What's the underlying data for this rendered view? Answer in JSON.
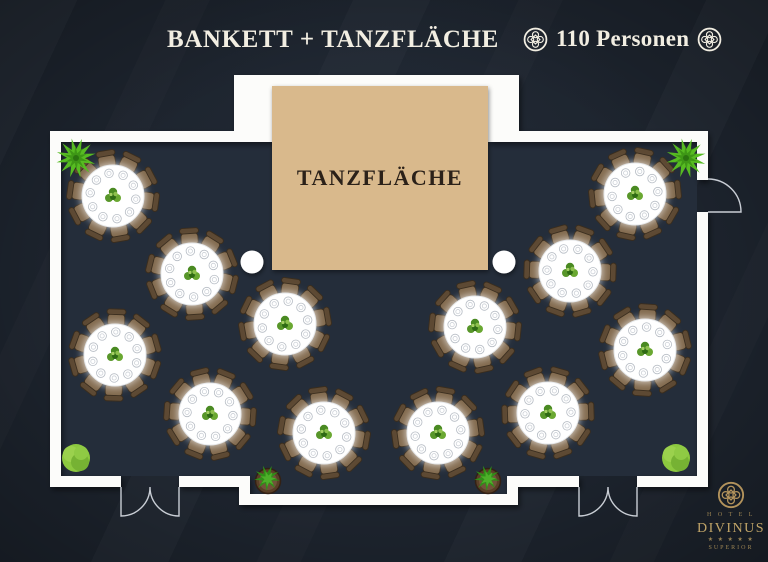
{
  "header": {
    "title": "BANKETT + TANZFLÄCHE",
    "capacity": "110 Personen",
    "ornament_icon": "celtic-knot-icon"
  },
  "floor_plan": {
    "dance_floor_label": "TANZFLÄCHE",
    "seats_per_table": 10,
    "table_count": 12,
    "colors": {
      "background": "#1d242e",
      "room_fill": "#242d3a",
      "wall": "#fcfcfa",
      "door_line": "#c9ced5",
      "dance_floor": "#d9b98c",
      "dance_floor_text": "#2b2119",
      "table_cloth": "#ffffff",
      "plate_rim": "#b6bcc4",
      "chair_seat": "#826a4e",
      "chair_back": "#5d4933",
      "chair_edge": "#3a2d1d",
      "column": "#ffffff",
      "plant_bright": "#57bb22",
      "plant_soft": "#8cc83f",
      "pot": "#5a3f27",
      "gold": "#b3935c"
    },
    "room_path": "M61,142 H697 V476 H507 V494 H250 V476 H61 Z",
    "walls": [
      [
        50,
        131,
        11,
        356
      ],
      [
        50,
        131,
        195,
        11
      ],
      [
        234,
        75,
        38,
        67
      ],
      [
        234,
        75,
        285,
        11
      ],
      [
        488,
        75,
        31,
        67
      ],
      [
        508,
        131,
        200,
        11
      ],
      [
        697,
        131,
        11,
        49
      ],
      [
        697,
        212,
        11,
        275
      ],
      [
        50,
        476,
        71,
        11
      ],
      [
        179,
        476,
        71,
        11
      ],
      [
        239,
        476,
        11,
        29
      ],
      [
        239,
        494,
        279,
        11
      ],
      [
        507,
        476,
        11,
        29
      ],
      [
        507,
        476,
        72,
        11
      ],
      [
        637,
        476,
        71,
        11
      ]
    ],
    "dance_floor_rect": [
      272,
      86,
      216,
      184
    ],
    "columns": [
      {
        "x": 252,
        "y": 262
      },
      {
        "x": 504,
        "y": 262
      }
    ],
    "tables": [
      {
        "x": 113,
        "y": 196,
        "rot": 8
      },
      {
        "x": 635,
        "y": 194,
        "rot": -6
      },
      {
        "x": 192,
        "y": 274,
        "rot": 14
      },
      {
        "x": 570,
        "y": 271,
        "rot": 2
      },
      {
        "x": 285,
        "y": 324,
        "rot": -10
      },
      {
        "x": 475,
        "y": 327,
        "rot": 6
      },
      {
        "x": 115,
        "y": 355,
        "rot": 20
      },
      {
        "x": 645,
        "y": 350,
        "rot": -14
      },
      {
        "x": 210,
        "y": 414,
        "rot": 4
      },
      {
        "x": 548,
        "y": 413,
        "rot": -2
      },
      {
        "x": 324,
        "y": 433,
        "rot": 10
      },
      {
        "x": 438,
        "y": 433,
        "rot": -8
      }
    ],
    "doors": [
      {
        "type": "double",
        "x1": 121,
        "x2": 179,
        "y": 487
      },
      {
        "type": "double",
        "x1": 579,
        "x2": 637,
        "y": 487
      },
      {
        "type": "single-right",
        "x": 708,
        "y1": 179,
        "y2": 212
      }
    ],
    "plants": [
      {
        "type": "spiky",
        "x": 76,
        "y": 158
      },
      {
        "type": "spiky",
        "x": 686,
        "y": 158
      },
      {
        "type": "bush",
        "x": 76,
        "y": 458
      },
      {
        "type": "bush",
        "x": 676,
        "y": 458
      },
      {
        "type": "potted",
        "x": 268,
        "y": 481
      },
      {
        "type": "potted",
        "x": 488,
        "y": 481
      }
    ]
  },
  "logo": {
    "hotel": "H O T E L",
    "name": "DIVINUS",
    "stars": "★ ★ ★ ★ ★",
    "tier": "SUPERIOR"
  }
}
